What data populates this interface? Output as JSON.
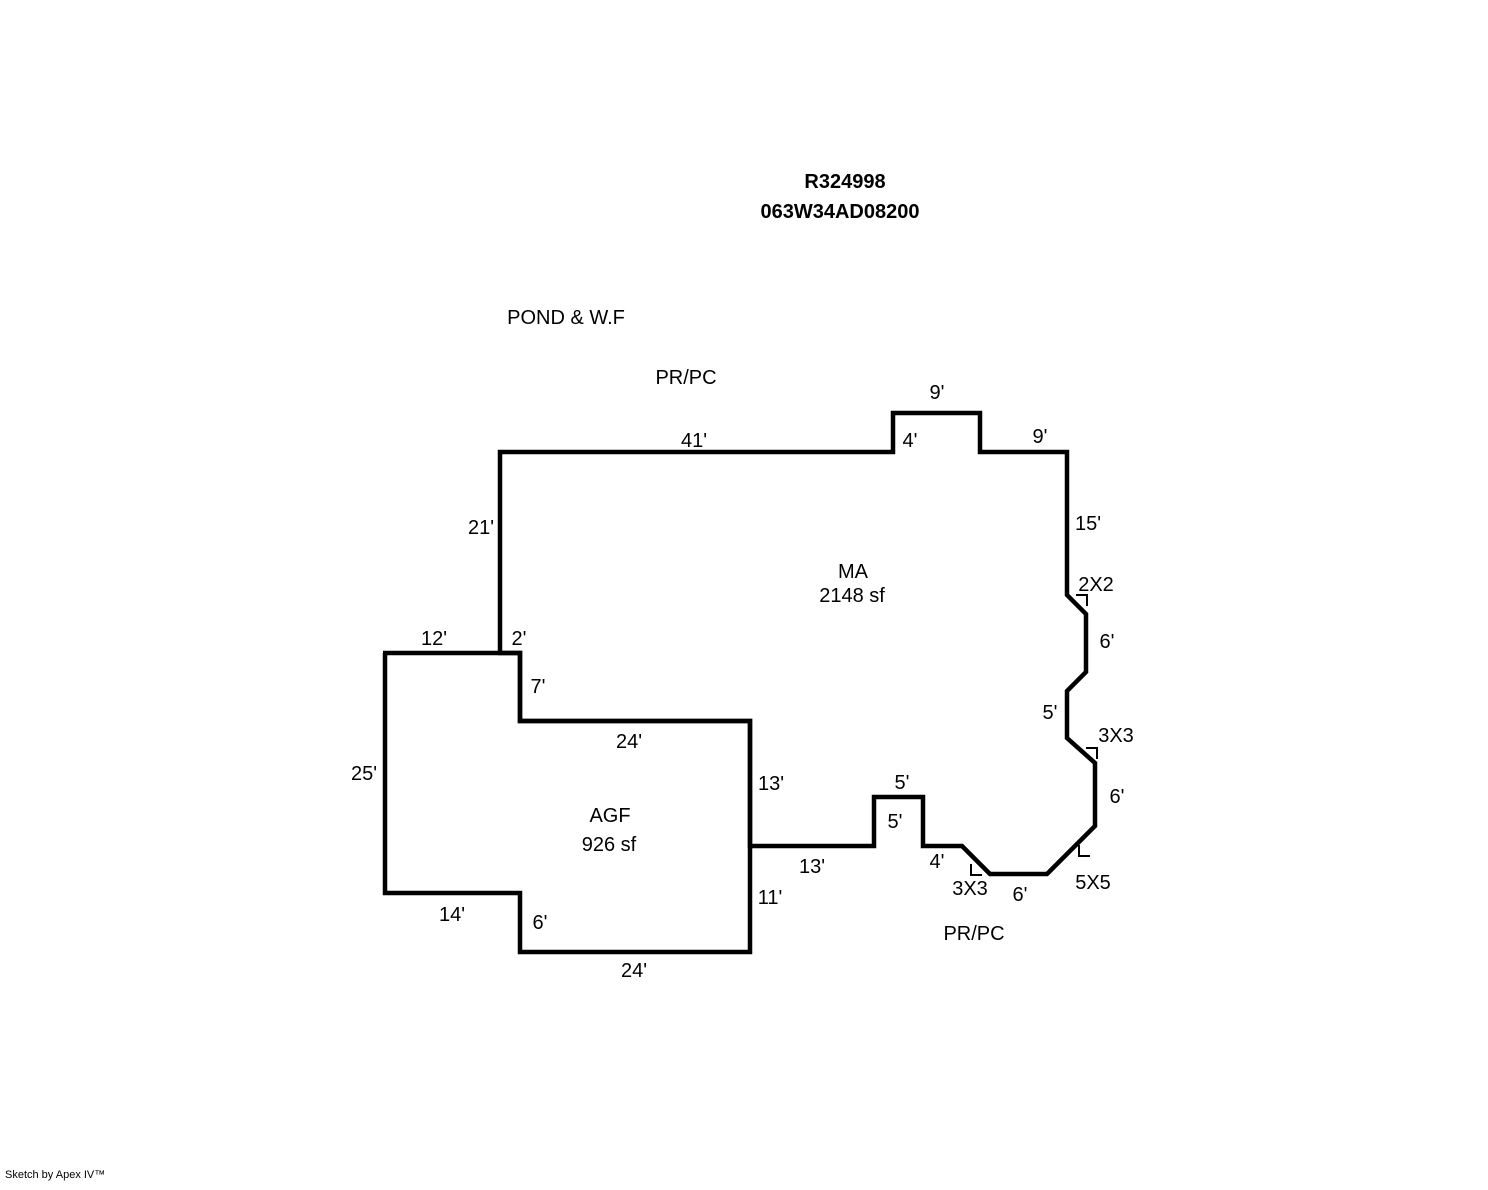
{
  "colors": {
    "ink": "#000000",
    "background": "#ffffff"
  },
  "header": {
    "line1": "R324998",
    "line2": "063W34AD08200",
    "line1_pos": {
      "x": 845,
      "y": 182
    },
    "line2_pos": {
      "x": 840,
      "y": 212
    }
  },
  "annotations": [
    {
      "text": "POND & W.F",
      "x": 566,
      "y": 318
    },
    {
      "text": "PR/PC",
      "x": 686,
      "y": 378
    },
    {
      "text": "PR/PC",
      "x": 974,
      "y": 934
    }
  ],
  "areas": [
    {
      "name": "MA",
      "sqft": "2148 sf",
      "name_pos": {
        "x": 853,
        "y": 572
      },
      "sqft_pos": {
        "x": 852,
        "y": 596
      }
    },
    {
      "name": "AGF",
      "sqft": "926 sf",
      "name_pos": {
        "x": 610,
        "y": 816
      },
      "sqft_pos": {
        "x": 609,
        "y": 845
      }
    }
  ],
  "dimensions": [
    {
      "text": "9'",
      "x": 937,
      "y": 393
    },
    {
      "text": "41'",
      "x": 694,
      "y": 441
    },
    {
      "text": "4'",
      "x": 910,
      "y": 441
    },
    {
      "text": "9'",
      "x": 1040,
      "y": 437
    },
    {
      "text": "15'",
      "x": 1088,
      "y": 524
    },
    {
      "text": "2X2",
      "x": 1096,
      "y": 585
    },
    {
      "text": "6'",
      "x": 1107,
      "y": 642
    },
    {
      "text": "21'",
      "x": 481,
      "y": 528
    },
    {
      "text": "12'",
      "x": 434,
      "y": 639
    },
    {
      "text": "2'",
      "x": 519,
      "y": 639
    },
    {
      "text": "7'",
      "x": 538,
      "y": 687
    },
    {
      "text": "24'",
      "x": 629,
      "y": 742
    },
    {
      "text": "5'",
      "x": 1050,
      "y": 713
    },
    {
      "text": "3X3",
      "x": 1116,
      "y": 736
    },
    {
      "text": "25'",
      "x": 364,
      "y": 774
    },
    {
      "text": "13'",
      "x": 771,
      "y": 784
    },
    {
      "text": "5'",
      "x": 902,
      "y": 783
    },
    {
      "text": "6'",
      "x": 1117,
      "y": 797
    },
    {
      "text": "5'",
      "x": 895,
      "y": 822
    },
    {
      "text": "13'",
      "x": 812,
      "y": 867
    },
    {
      "text": "4'",
      "x": 937,
      "y": 862
    },
    {
      "text": "3X3",
      "x": 970,
      "y": 889
    },
    {
      "text": "6'",
      "x": 1020,
      "y": 895
    },
    {
      "text": "5X5",
      "x": 1093,
      "y": 883
    },
    {
      "text": "11'",
      "x": 770,
      "y": 898
    },
    {
      "text": "14'",
      "x": 452,
      "y": 915
    },
    {
      "text": "6'",
      "x": 540,
      "y": 923
    },
    {
      "text": "24'",
      "x": 634,
      "y": 971
    }
  ],
  "outlines": [
    {
      "id": "ma",
      "points": [
        [
          500,
          452
        ],
        [
          893,
          452
        ],
        [
          893,
          413
        ],
        [
          980,
          413
        ],
        [
          980,
          452
        ],
        [
          1067,
          452
        ],
        [
          1067,
          595
        ],
        [
          1086,
          614
        ],
        [
          1086,
          672
        ],
        [
          1067,
          691
        ],
        [
          1067,
          738
        ],
        [
          1095,
          763
        ],
        [
          1095,
          826
        ],
        [
          1047,
          874
        ],
        [
          990,
          874
        ],
        [
          962,
          846
        ],
        [
          923,
          846
        ],
        [
          923,
          797
        ],
        [
          874,
          797
        ],
        [
          874,
          846
        ],
        [
          750,
          846
        ],
        [
          750,
          721
        ],
        [
          520,
          721
        ],
        [
          520,
          653
        ],
        [
          500,
          653
        ]
      ]
    },
    {
      "id": "agf",
      "points": [
        [
          383,
          653
        ],
        [
          520,
          653
        ],
        [
          520,
          721
        ],
        [
          750,
          721
        ],
        [
          750,
          952
        ],
        [
          520,
          952
        ],
        [
          520,
          893
        ],
        [
          385,
          893
        ],
        [
          385,
          653
        ]
      ]
    }
  ],
  "corner_marks": [
    {
      "id": "2x2-angle",
      "points": [
        [
          1076,
          595
        ],
        [
          1087,
          595
        ],
        [
          1087,
          606
        ]
      ]
    },
    {
      "id": "3x3-right-angle",
      "points": [
        [
          1086,
          748
        ],
        [
          1097,
          748
        ],
        [
          1097,
          759
        ]
      ]
    },
    {
      "id": "5x5-angle",
      "points": [
        [
          1079,
          845
        ],
        [
          1079,
          856
        ],
        [
          1090,
          856
        ]
      ]
    },
    {
      "id": "3x3-bottom-angle",
      "points": [
        [
          971,
          864
        ],
        [
          971,
          875
        ],
        [
          982,
          875
        ]
      ]
    }
  ],
  "footer": {
    "credit": "Sketch by Apex IV™"
  }
}
